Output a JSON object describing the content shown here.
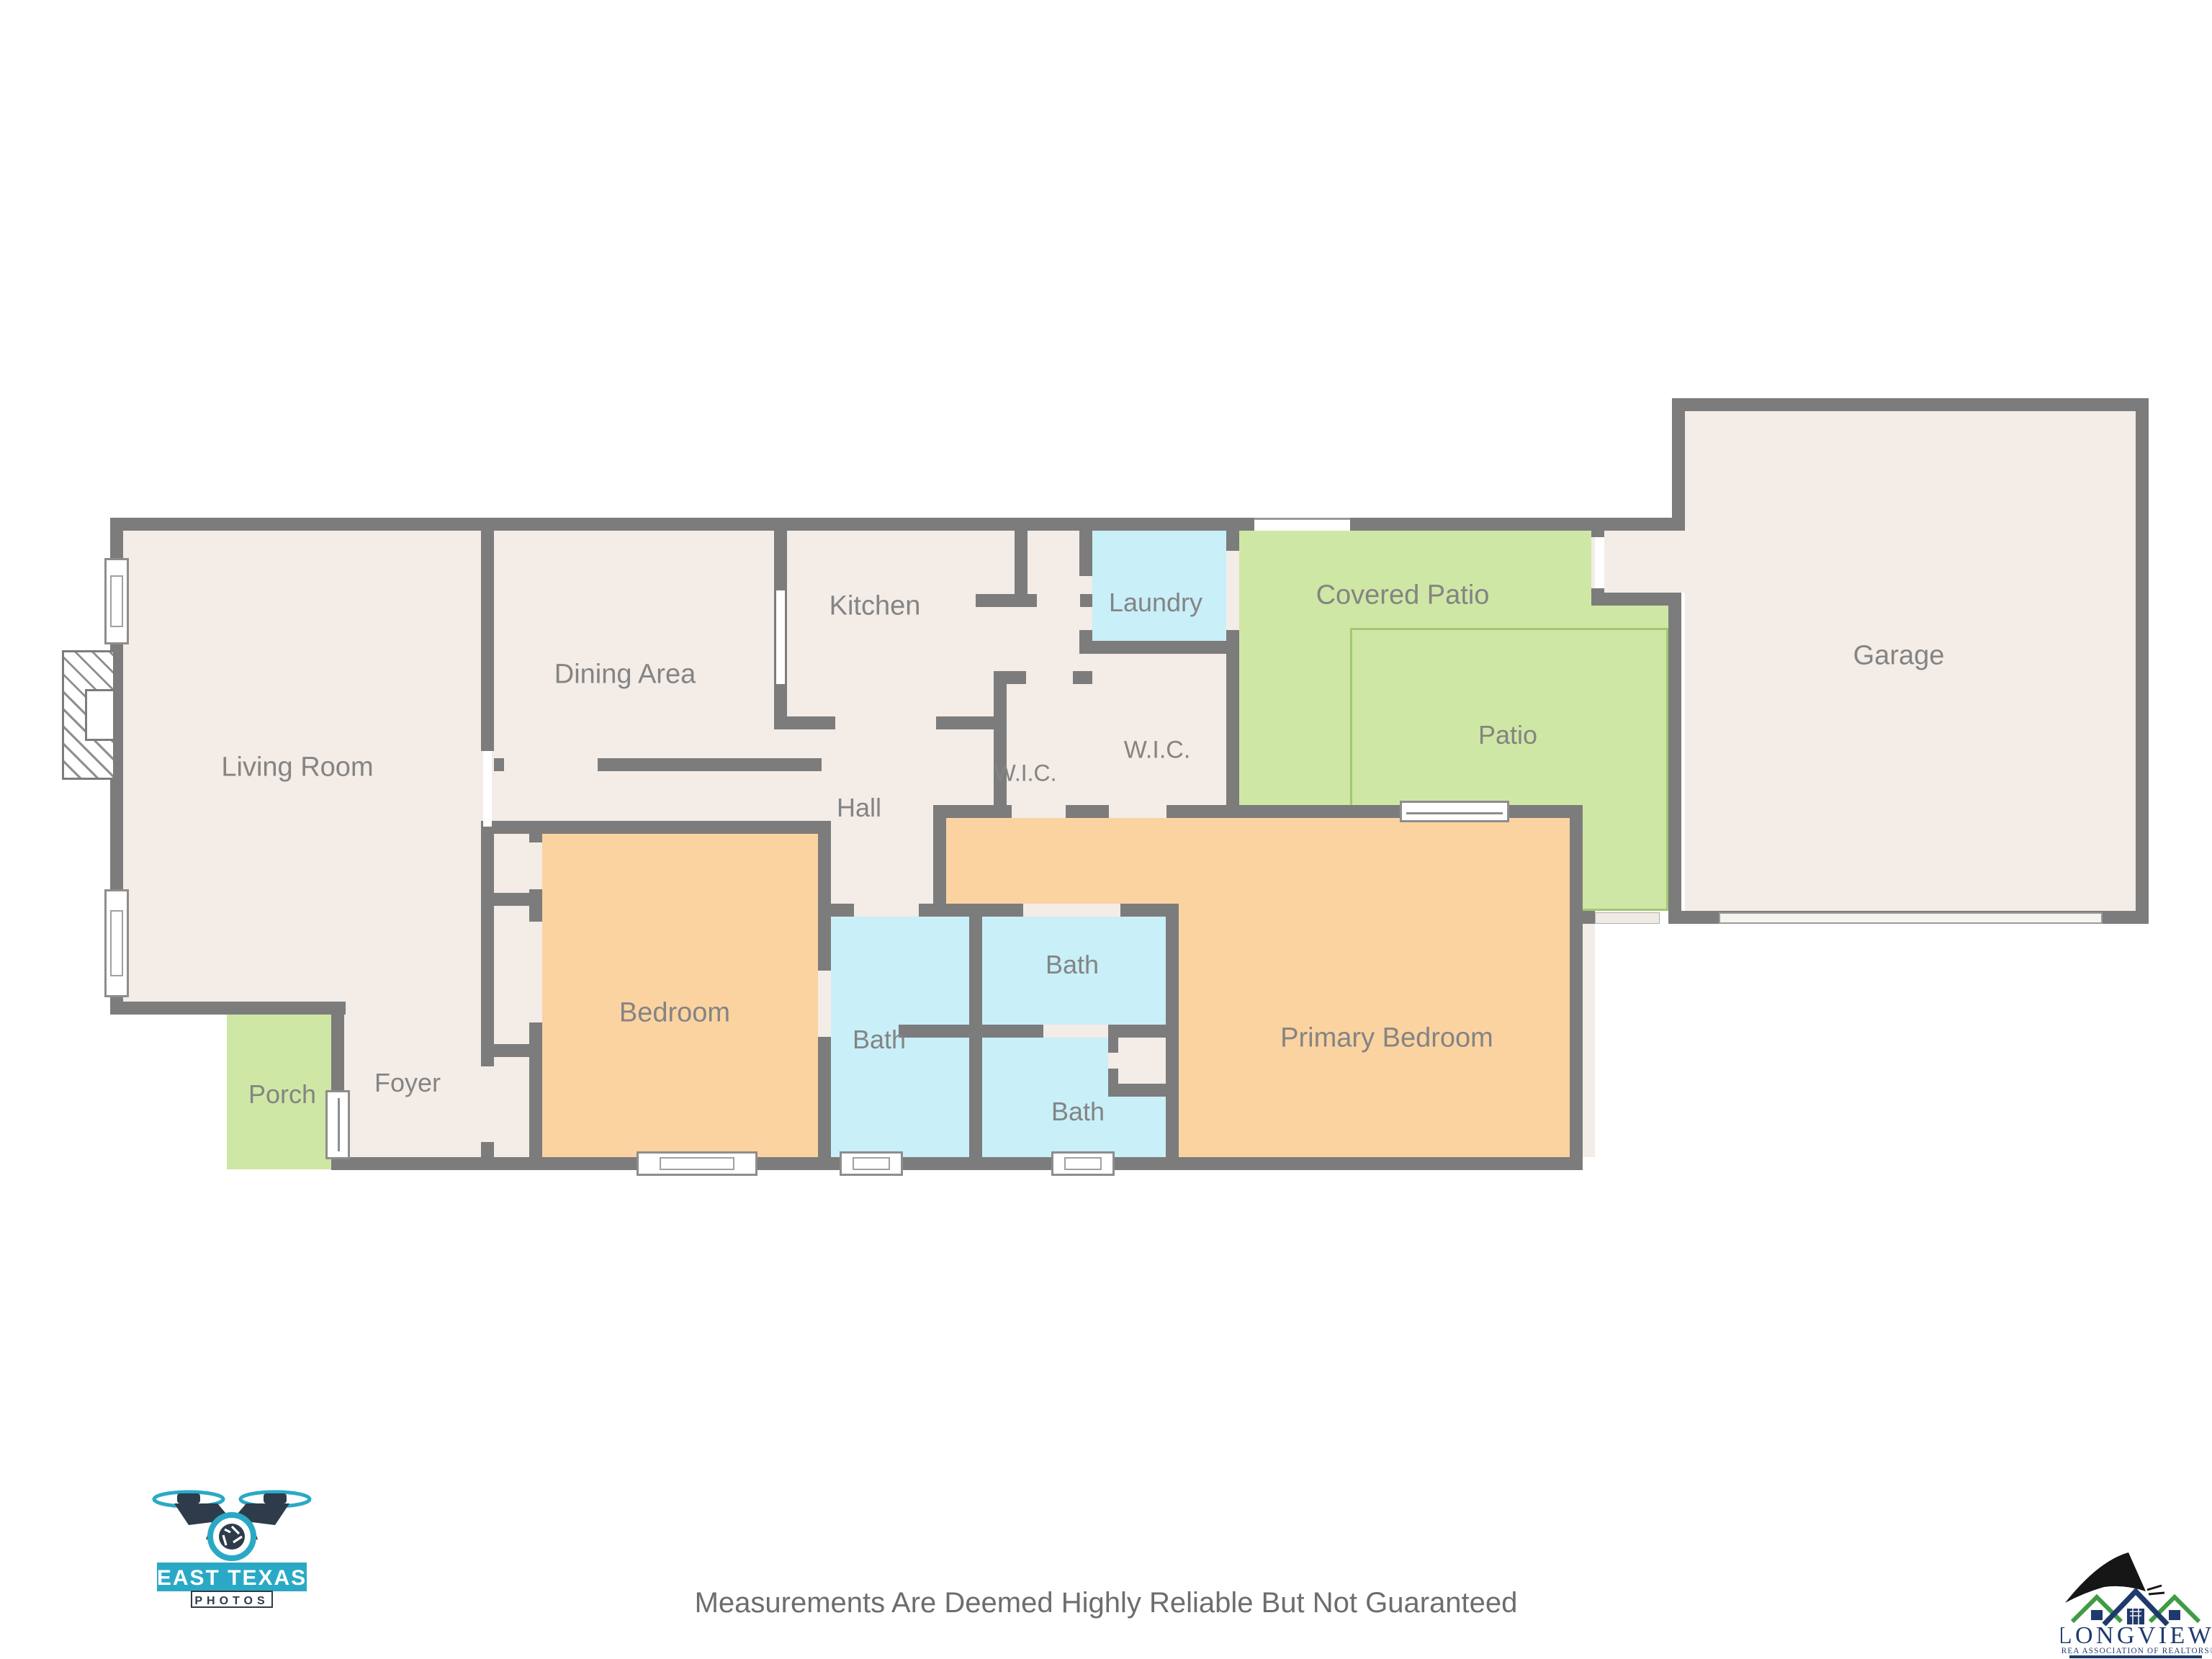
{
  "floorplan": {
    "rooms": [
      {
        "label": "Living Room"
      },
      {
        "label": "Dining Area"
      },
      {
        "label": "Kitchen"
      },
      {
        "label": "Laundry"
      },
      {
        "label": "Covered Patio"
      },
      {
        "label": "Patio"
      },
      {
        "label": "Garage"
      },
      {
        "label": "W.I.C."
      },
      {
        "label": "W.I.C."
      },
      {
        "label": "Hall"
      },
      {
        "label": "Bedroom"
      },
      {
        "label": "Bath"
      },
      {
        "label": "Bath"
      },
      {
        "label": "Bath"
      },
      {
        "label": "Primary Bedroom"
      },
      {
        "label": "Foyer"
      },
      {
        "label": "Porch"
      }
    ],
    "colors": {
      "wall": "#7c7c7c",
      "interior_floor": "#f3ece7",
      "bedroom_floor": "#fbd3a1",
      "bath_floor": "#c9eff8",
      "outdoor_green": "#cfe7a4",
      "patio_outline": "#a2c873",
      "label_text": "#848484"
    }
  },
  "footer": {
    "disclaimer": "Measurements Are Deemed Highly Reliable But Not Guaranteed"
  },
  "logos": {
    "photographer": {
      "line1": "EAST TEXAS",
      "line2": "PHOTOS"
    },
    "association": {
      "name": "LONGVIEW",
      "subtitle": "AREA ASSOCIATION OF REALTORS®"
    }
  }
}
